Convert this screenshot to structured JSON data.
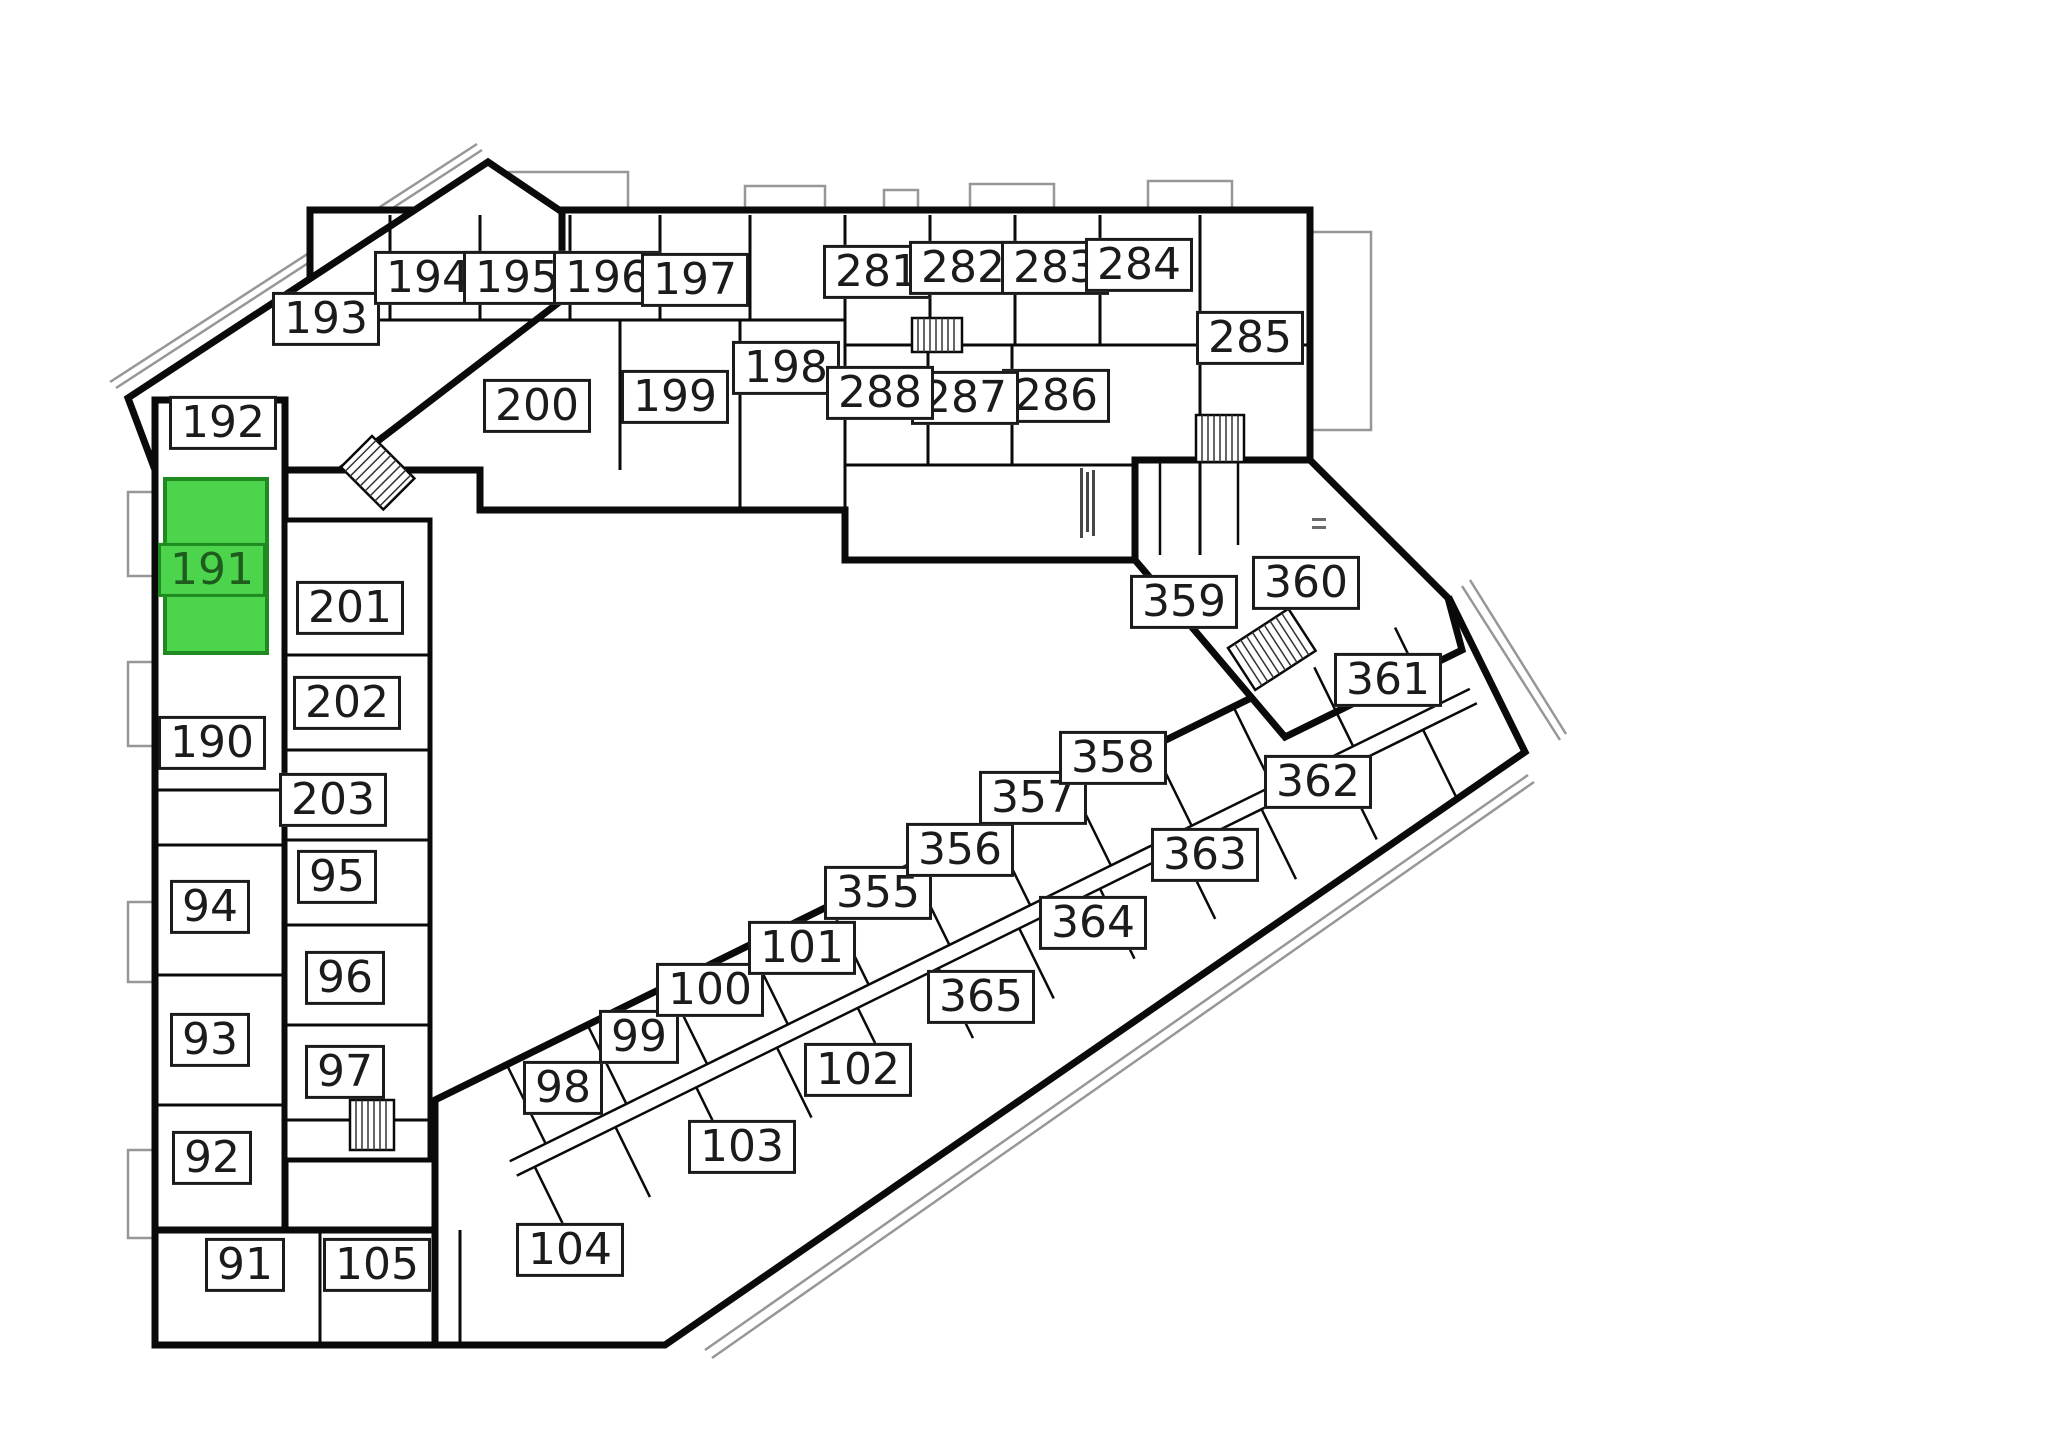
{
  "selected_unit": "191",
  "colors": {
    "highlight": "#4dd44d",
    "highlight_border": "#1f8a1f",
    "highlight_text": "#1d5c1d",
    "wall": "#0a0a0a",
    "balcony_outline": "#979797",
    "background": "#ffffff"
  },
  "labels": {
    "r91": "91",
    "r92": "92",
    "r93": "93",
    "r94": "94",
    "r95": "95",
    "r96": "96",
    "r97": "97",
    "r98": "98",
    "r99": "99",
    "r100": "100",
    "r101": "101",
    "r102": "102",
    "r103": "103",
    "r104": "104",
    "r105": "105",
    "r190": "190",
    "r191": "191",
    "r192": "192",
    "r193": "193",
    "r194": "194",
    "r195": "195",
    "r196": "196",
    "r197": "197",
    "r198": "198",
    "r199": "199",
    "r200": "200",
    "r201": "201",
    "r202": "202",
    "r203": "203",
    "r281": "281",
    "r282": "282",
    "r283": "283",
    "r284": "284",
    "r285": "285",
    "r286": "286",
    "r287": "287",
    "r288": "288",
    "r355": "355",
    "r356": "356",
    "r357": "357",
    "r358": "358",
    "r359": "359",
    "r360": "360",
    "r361": "361",
    "r362": "362",
    "r363": "363",
    "r364": "364",
    "r365": "365"
  }
}
